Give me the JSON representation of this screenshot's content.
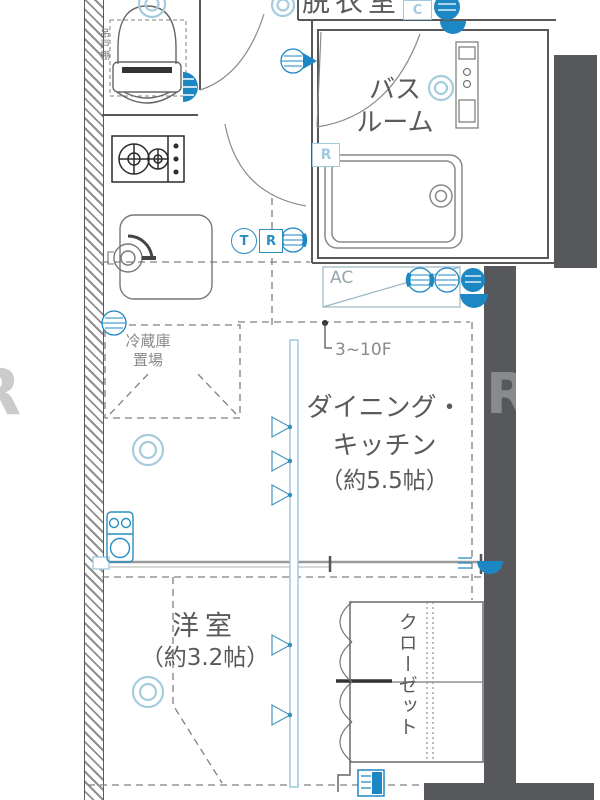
{
  "rooms": {
    "dressing": {
      "label": "脱衣室"
    },
    "bathroom": {
      "line1": "バス",
      "line2": "ルーム"
    },
    "dining_kitchen": {
      "line1": "ダイニング・",
      "line2": "キッチン",
      "line3": "（約5.5帖）"
    },
    "western_room": {
      "line1": "洋室",
      "line2": "（約3.2帖）"
    },
    "closet": {
      "label": "クローゼット"
    },
    "fridge_space": {
      "line1": "冷蔵庫",
      "line2": "置場"
    },
    "hanging_cabinet": {
      "label": "吊戸棚"
    }
  },
  "annotations": {
    "floor_range": "3~10F",
    "ac_unit": "AC",
    "bath_reheat_symbol": "R",
    "c_outlet_symbol": "C",
    "telephone_symbol": "T",
    "router_symbol": "R",
    "watermark_left": "R",
    "watermark_right": "R"
  },
  "colors": {
    "accent_blue": "#1d87c4",
    "light_blue": "#9fcade",
    "structure_dark": "#57585b",
    "line_gray": "#6a6a6a"
  }
}
